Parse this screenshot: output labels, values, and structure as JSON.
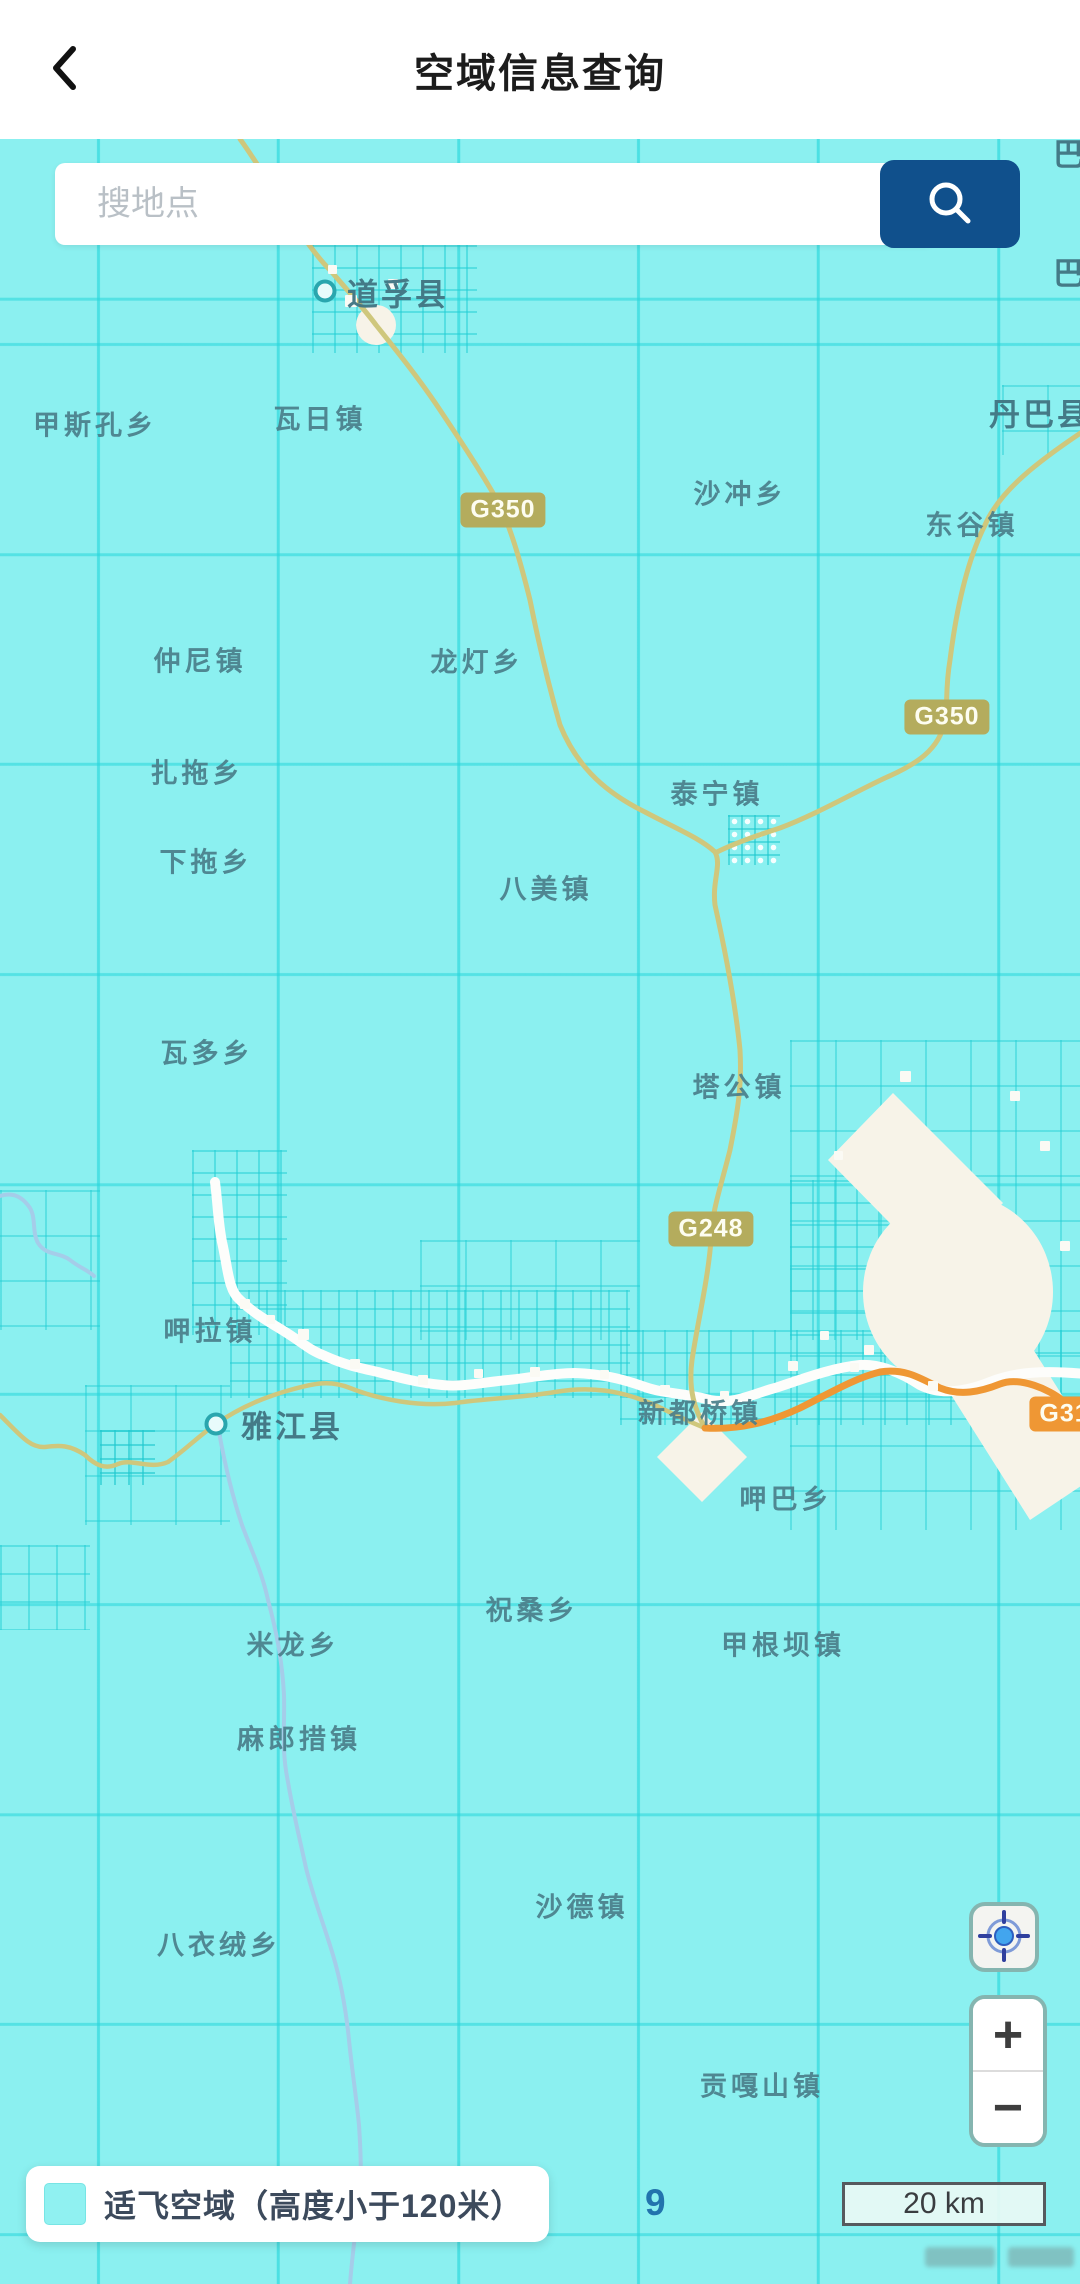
{
  "header": {
    "title": "空域信息查询"
  },
  "search": {
    "placeholder": "搜地点",
    "value": ""
  },
  "legend": {
    "label": "适飞空域（高度小于120米）",
    "swatch_color": "#90F1F1"
  },
  "map": {
    "zoom_level": "9",
    "scale_label": "20 km",
    "colors": {
      "flight_zone": "#8BF0F0",
      "grid_line": "#26D6DB",
      "restricted_zone": "#F7F3E8",
      "road": "#CFC77C",
      "road_major": "#EF9734",
      "river": "#FDFDFB",
      "stream": "#A5CDE9",
      "label": "#4A7E8A"
    },
    "place_labels": [
      {
        "text": "道孚县",
        "type": "county",
        "x": 398,
        "y": 153
      },
      {
        "text": "瓦日镇",
        "type": "town",
        "x": 320,
        "y": 278
      },
      {
        "text": "甲斯孔乡",
        "type": "town",
        "x": 95,
        "y": 284
      },
      {
        "text": "丹巴县",
        "type": "county",
        "x": 1040,
        "y": 273
      },
      {
        "text": "巴",
        "type": "county",
        "x": 1070,
        "y": 132
      },
      {
        "text": "巴",
        "type": "county",
        "x": 1070,
        "y": 13
      },
      {
        "text": "沙冲乡",
        "type": "town",
        "x": 740,
        "y": 353
      },
      {
        "text": "东谷镇",
        "type": "town",
        "x": 972,
        "y": 384
      },
      {
        "text": "仲尼镇",
        "type": "town",
        "x": 200,
        "y": 520
      },
      {
        "text": "龙灯乡",
        "type": "town",
        "x": 477,
        "y": 521
      },
      {
        "text": "扎拖乡",
        "type": "town",
        "x": 197,
        "y": 632
      },
      {
        "text": "泰宁镇",
        "type": "town",
        "x": 717,
        "y": 653
      },
      {
        "text": "下拖乡",
        "type": "town",
        "x": 206,
        "y": 721
      },
      {
        "text": "八美镇",
        "type": "town",
        "x": 546,
        "y": 748
      },
      {
        "text": "瓦多乡",
        "type": "town",
        "x": 207,
        "y": 912
      },
      {
        "text": "塔公镇",
        "type": "town",
        "x": 739,
        "y": 946
      },
      {
        "text": "呷拉镇",
        "type": "town",
        "x": 210,
        "y": 1190
      },
      {
        "text": "雅江县",
        "type": "county",
        "x": 292,
        "y": 1285
      },
      {
        "text": "新都桥镇",
        "type": "town",
        "x": 700,
        "y": 1272
      },
      {
        "text": "呷巴乡",
        "type": "town",
        "x": 786,
        "y": 1358
      },
      {
        "text": "祝桑乡",
        "type": "town",
        "x": 532,
        "y": 1469
      },
      {
        "text": "米龙乡",
        "type": "town",
        "x": 293,
        "y": 1504
      },
      {
        "text": "甲根坝镇",
        "type": "town",
        "x": 783,
        "y": 1504
      },
      {
        "text": "麻郎措镇",
        "type": "town",
        "x": 299,
        "y": 1598
      },
      {
        "text": "沙德镇",
        "type": "town",
        "x": 582,
        "y": 1766
      },
      {
        "text": "八衣绒乡",
        "type": "town",
        "x": 219,
        "y": 1804
      },
      {
        "text": "贡嘎山镇",
        "type": "town",
        "x": 762,
        "y": 1945
      }
    ],
    "road_badges": [
      {
        "text": "G350",
        "style": "national",
        "x": 503,
        "y": 371
      },
      {
        "text": "G350",
        "style": "national",
        "x": 947,
        "y": 578
      },
      {
        "text": "G248",
        "style": "national",
        "x": 711,
        "y": 1090
      },
      {
        "text": "G318",
        "style": "orange",
        "x": 1072,
        "y": 1275
      }
    ],
    "city_markers": [
      {
        "x": 325,
        "y": 152
      },
      {
        "x": 216,
        "y": 1285
      }
    ]
  },
  "controls": {
    "zoom_in": "+",
    "zoom_out": "−"
  }
}
